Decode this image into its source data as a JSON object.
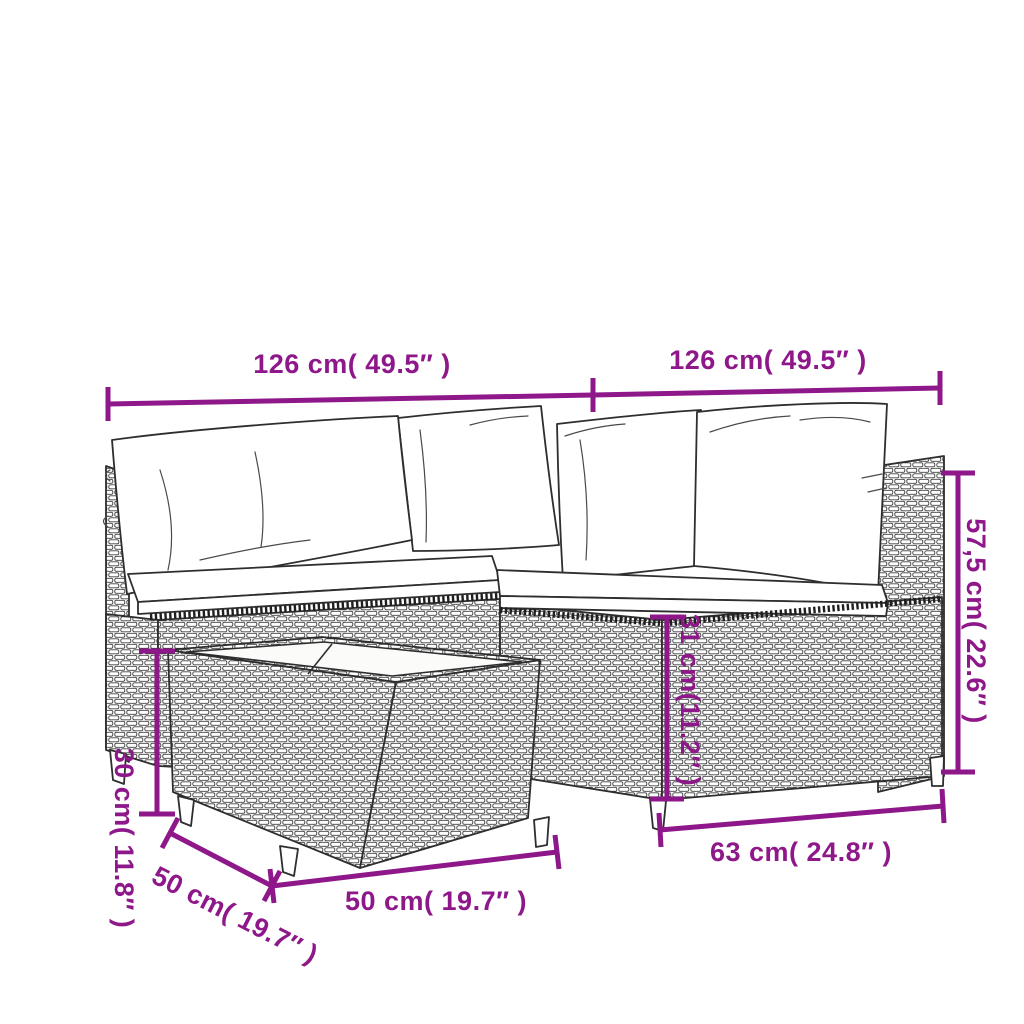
{
  "image_type": "product-dimension-diagram",
  "product": "rattan-garden-lounge-set-line-drawing",
  "colors": {
    "accent": "#8E178A",
    "line_art": "#2e2e2e",
    "background": "#ffffff",
    "cushion": "#ffffff",
    "table_top": "#fbfbf9"
  },
  "dimensions": {
    "sofa_width_left": "126 cm( 49.5″ )",
    "sofa_width_right": "126 cm( 49.5″ )",
    "back_height": "57,5 cm( 22.6″ )",
    "seat_height": "31 cm(11.2″ )",
    "seat_depth": "63 cm( 24.8″ )",
    "table_width": "50 cm( 19.7″ )",
    "table_depth": "50 cm( 19.7″ )",
    "table_height": "30 cm( 11.8″ )"
  }
}
